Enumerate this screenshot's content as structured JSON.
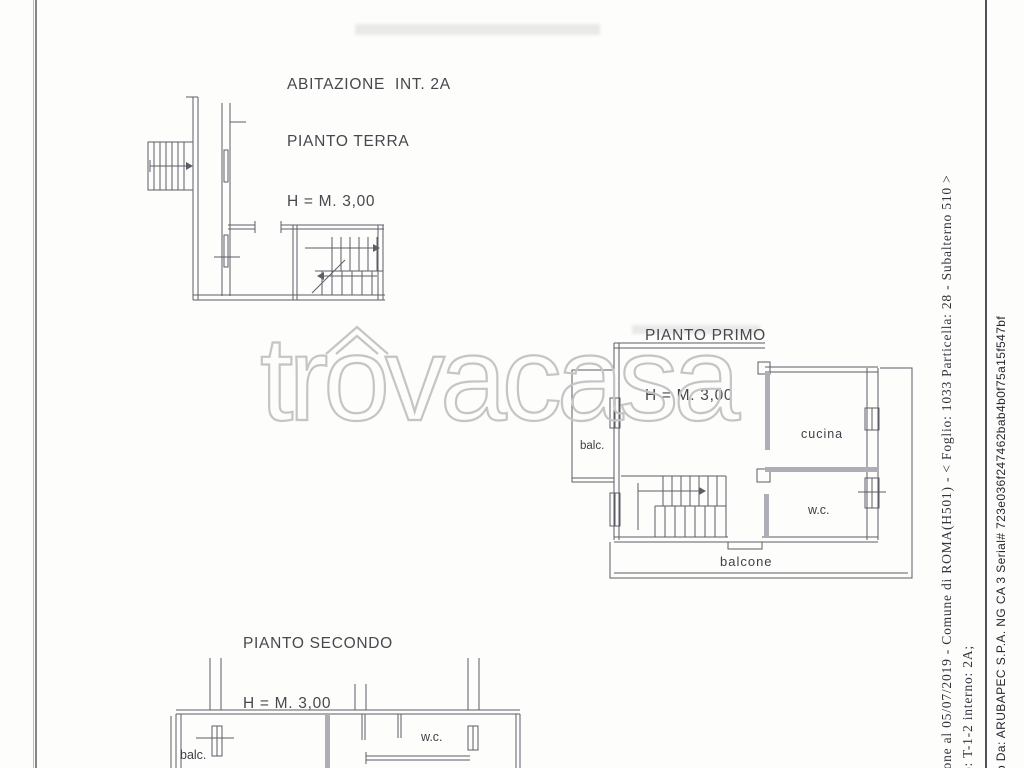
{
  "plans": {
    "terra": {
      "unit_label": "ABITAZIONE  INT. 2A",
      "floor_label": "PIANTO TERRA",
      "height_label": "H = M. 3,00"
    },
    "primo": {
      "floor_label": "PIANTO PRIMO",
      "height_label": "H = M. 3,00",
      "rooms": {
        "balcony_small": "balc.",
        "kitchen": "cucina",
        "wc": "w.c.",
        "balcony_long": "balcone"
      }
    },
    "secondo": {
      "floor_label": "PIANTO SECONDO",
      "height_label": "H = M. 3,00",
      "rooms": {
        "balcony_small": "balc.",
        "wc": "w.c."
      }
    }
  },
  "watermark": {
    "text": "trovacasa"
  },
  "margin_notes": {
    "registration_line": "ione al 05/07/2019 - Comune di ROMA(H501) - < Foglio: 1033 Particella: 28 - Subalterno 510 >",
    "unit_line": "o: T-1-2 interno: 2A;",
    "signature_line": "o Da: ARUBAPEC S.P.A. NG CA 3 Serial# 723e036f247462bab4b0f75a15f547bf"
  },
  "colors": {
    "plan_line": "#5d5d66",
    "wall_fill": "#aeaeb6",
    "label_text": "#47474d",
    "watermark_stroke": "#c5c5c5",
    "margin_serif_text": "#33333b",
    "margin_sans_text": "#26262e"
  }
}
